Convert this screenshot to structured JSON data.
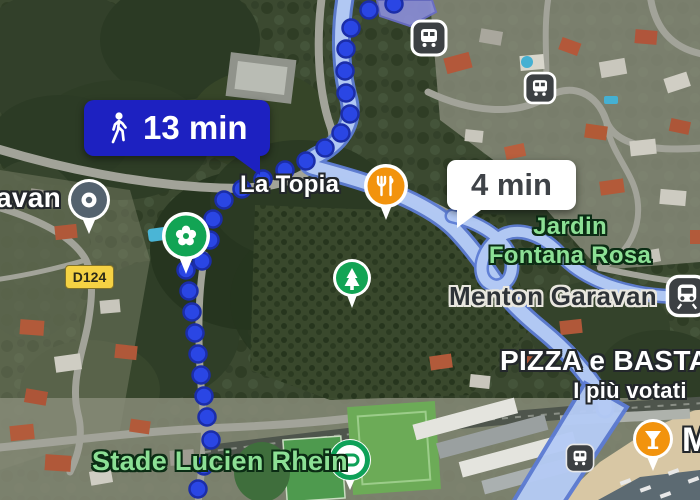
{
  "app": {
    "name": "Google Maps",
    "view": "satellite-walking-directions"
  },
  "bubbles": {
    "walk_total": "13 min",
    "walk_segment": "4 min"
  },
  "labels": {
    "garavan_partial": "avan",
    "la_topia": "La Topia",
    "jardin_line1": "Jardin",
    "jardin_line2": "Fontana Rosa",
    "menton_garavan": "Menton Garavan",
    "pizza": "PIZZA e BASTA",
    "pizza_votes": "I più votati",
    "stade": "Stade Lucien Rhein",
    "label_partial_right": "M",
    "road_badge": "D124"
  },
  "icons": {
    "walk": "walking-person-icon",
    "restaurant": "fork-knife-pin",
    "garden": "flower-pin",
    "park": "tree-pin",
    "stadium": "sports-venue-pin",
    "bar": "cocktail-pin",
    "bus": "bus-stop-icon",
    "train": "train-station-icon",
    "generic_poi": "gray-location-pin"
  },
  "colors": {
    "bubble_blue": "#1d21c1",
    "walk_dot_blue": "#2a46e4",
    "walk_dot_edge": "#1b2da8",
    "route_fill": "#b5cbf5",
    "route_casing": "#5d7cd4",
    "poi_orange": "#f2930d",
    "poi_green": "#12a454",
    "label_green": "#8ce095",
    "badge_yellow": "#f5d244"
  }
}
